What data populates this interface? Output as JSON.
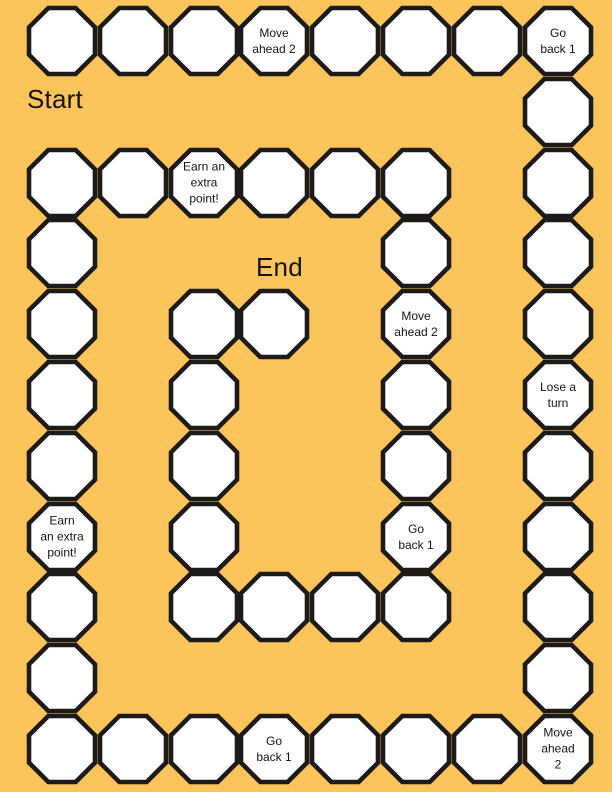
{
  "colors": {
    "background": "#FBC55C",
    "space_fill": "#FFFFFF",
    "space_border": "#1C1B19",
    "text": "#151413"
  },
  "labels": {
    "start": "Start",
    "end": "End"
  },
  "special_space_texts": [
    "Move ahead 2",
    "Go back 1",
    "Lose a turn",
    "Earn an extra point!"
  ],
  "board": {
    "columns": 8,
    "rows": 11,
    "space_count": 52,
    "spaces": [
      {
        "col": 0,
        "row": 0,
        "lines": []
      },
      {
        "col": 1,
        "row": 0,
        "lines": []
      },
      {
        "col": 2,
        "row": 0,
        "lines": []
      },
      {
        "col": 3,
        "row": 0,
        "lines": [
          "Move",
          "ahead 2"
        ]
      },
      {
        "col": 4,
        "row": 0,
        "lines": []
      },
      {
        "col": 5,
        "row": 0,
        "lines": []
      },
      {
        "col": 6,
        "row": 0,
        "lines": []
      },
      {
        "col": 7,
        "row": 0,
        "lines": [
          "Go",
          "back 1"
        ]
      },
      {
        "col": 7,
        "row": 1,
        "lines": []
      },
      {
        "col": 7,
        "row": 2,
        "lines": []
      },
      {
        "col": 7,
        "row": 3,
        "lines": []
      },
      {
        "col": 7,
        "row": 4,
        "lines": []
      },
      {
        "col": 7,
        "row": 5,
        "lines": [
          "Lose a",
          "turn"
        ]
      },
      {
        "col": 7,
        "row": 6,
        "lines": []
      },
      {
        "col": 7,
        "row": 7,
        "lines": []
      },
      {
        "col": 7,
        "row": 8,
        "lines": []
      },
      {
        "col": 7,
        "row": 9,
        "lines": []
      },
      {
        "col": 7,
        "row": 10,
        "lines": [
          "Move",
          "ahead",
          "2"
        ]
      },
      {
        "col": 6,
        "row": 10,
        "lines": []
      },
      {
        "col": 5,
        "row": 10,
        "lines": []
      },
      {
        "col": 4,
        "row": 10,
        "lines": []
      },
      {
        "col": 3,
        "row": 10,
        "lines": [
          "Go",
          "back 1"
        ]
      },
      {
        "col": 2,
        "row": 10,
        "lines": []
      },
      {
        "col": 1,
        "row": 10,
        "lines": []
      },
      {
        "col": 0,
        "row": 10,
        "lines": []
      },
      {
        "col": 0,
        "row": 9,
        "lines": []
      },
      {
        "col": 0,
        "row": 8,
        "lines": []
      },
      {
        "col": 0,
        "row": 7,
        "lines": [
          "Earn",
          "an extra",
          "point!"
        ]
      },
      {
        "col": 0,
        "row": 6,
        "lines": []
      },
      {
        "col": 0,
        "row": 5,
        "lines": []
      },
      {
        "col": 0,
        "row": 4,
        "lines": []
      },
      {
        "col": 0,
        "row": 3,
        "lines": []
      },
      {
        "col": 0,
        "row": 2,
        "lines": []
      },
      {
        "col": 1,
        "row": 2,
        "lines": []
      },
      {
        "col": 2,
        "row": 2,
        "lines": [
          "Earn an",
          "extra",
          "point!"
        ]
      },
      {
        "col": 3,
        "row": 2,
        "lines": []
      },
      {
        "col": 4,
        "row": 2,
        "lines": []
      },
      {
        "col": 5,
        "row": 2,
        "lines": []
      },
      {
        "col": 5,
        "row": 3,
        "lines": []
      },
      {
        "col": 5,
        "row": 4,
        "lines": [
          "Move",
          "ahead 2"
        ]
      },
      {
        "col": 5,
        "row": 5,
        "lines": []
      },
      {
        "col": 5,
        "row": 6,
        "lines": []
      },
      {
        "col": 5,
        "row": 7,
        "lines": [
          "Go",
          "back 1"
        ]
      },
      {
        "col": 5,
        "row": 8,
        "lines": []
      },
      {
        "col": 4,
        "row": 8,
        "lines": []
      },
      {
        "col": 3,
        "row": 8,
        "lines": []
      },
      {
        "col": 2,
        "row": 8,
        "lines": []
      },
      {
        "col": 2,
        "row": 7,
        "lines": []
      },
      {
        "col": 2,
        "row": 6,
        "lines": []
      },
      {
        "col": 2,
        "row": 5,
        "lines": []
      },
      {
        "col": 2,
        "row": 4,
        "lines": []
      },
      {
        "col": 3,
        "row": 4,
        "lines": []
      }
    ]
  }
}
